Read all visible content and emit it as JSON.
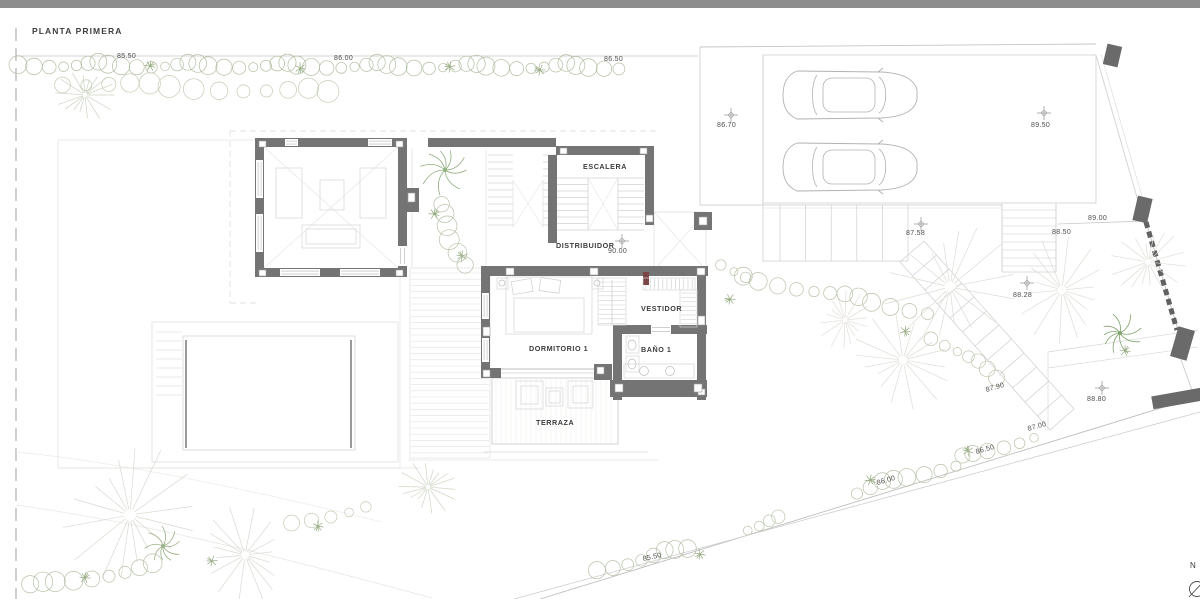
{
  "title": "PLANTA PRIMERA",
  "rooms": {
    "escalera": "ESCALERA",
    "distribuidor": "DISTRIBUIDOR",
    "dormitorio1": "DORMITORIO 1",
    "vestidor": "VESTIDOR",
    "bano1": "BAÑO 1",
    "terraza": "TERRAZA"
  },
  "elevations": [
    "85.50",
    "86.00",
    "86.50",
    "86.70",
    "89.50",
    "90.00",
    "87.58",
    "89.00",
    "88.50",
    "88.28",
    "87.90",
    "88.80",
    "87.00",
    "86.50",
    "86.00",
    "85.50"
  ],
  "compass": {
    "north_label": "N"
  },
  "colors": {
    "wall": "#747474",
    "boundary_pier": "#6a6a6a",
    "window_chrome": "#8d8d8d",
    "vegetation": "#9fb08c",
    "line_light": "#cccccc",
    "text": "#4d4d4d",
    "closet_marker": "#7a4444"
  }
}
